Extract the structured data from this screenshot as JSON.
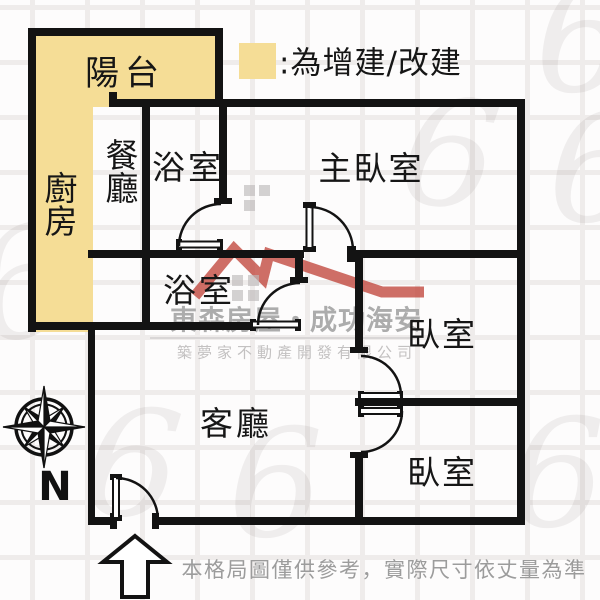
{
  "legend": {
    "label": ":為增建/改建"
  },
  "rooms": {
    "balcony": "陽台",
    "kitchen": "廚房",
    "dining": "餐廳",
    "bathroom1": "浴室",
    "master_bedroom": "主臥室",
    "bathroom2": "浴室",
    "bedroom1": "臥室",
    "bedroom2": "臥室",
    "living_room": "客廳"
  },
  "compass": {
    "north_label": "N"
  },
  "watermark": {
    "brand": "東森房屋・成功海安",
    "company": "築夢家不動產開發有限公司",
    "decor_glyph": "6"
  },
  "footer": {
    "disclaimer": "本格局圖僅供參考，實際尺寸依丈量為準"
  },
  "colors": {
    "highlight_yellow": "#F5DD96",
    "wall_black": "#131313",
    "logo_red": "#C24A40",
    "watermark_gray": "#ACACAC"
  }
}
